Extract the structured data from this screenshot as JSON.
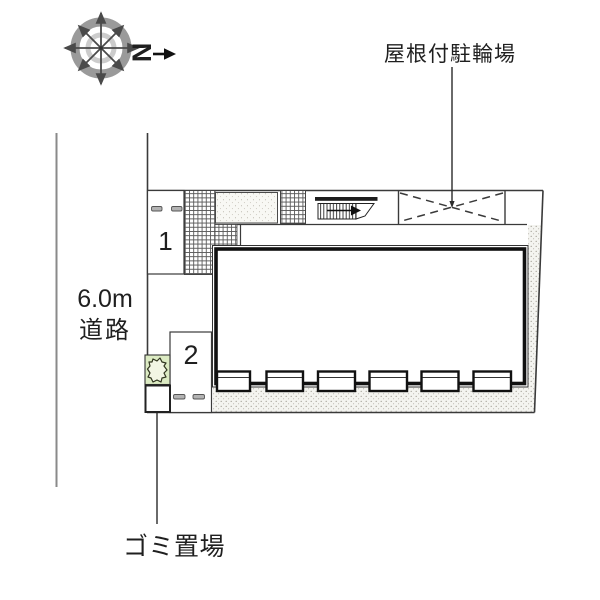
{
  "compass": {
    "north_label": "N"
  },
  "annotations": {
    "bicycle_parking_label": "屋根付駐輪場",
    "road_width_label": "6.0m",
    "road_label": "道路",
    "garbage_label": "ゴミ置場"
  },
  "parking_spaces": [
    {
      "number": "1"
    },
    {
      "number": "2"
    }
  ],
  "colors": {
    "line": "#3a3a3a",
    "wall": "#1a1a1a",
    "bush_box_fill": "#dcebc3",
    "bush_blob_fill": "#f2f6e4",
    "hatch_line": "#5a5a5a",
    "stipple_dot": "#a39f96",
    "compass_ring_outer": "#9a9a9a",
    "compass_ring_inner": "#cccccc",
    "parking_dash_fill": "#b3b3b3"
  }
}
